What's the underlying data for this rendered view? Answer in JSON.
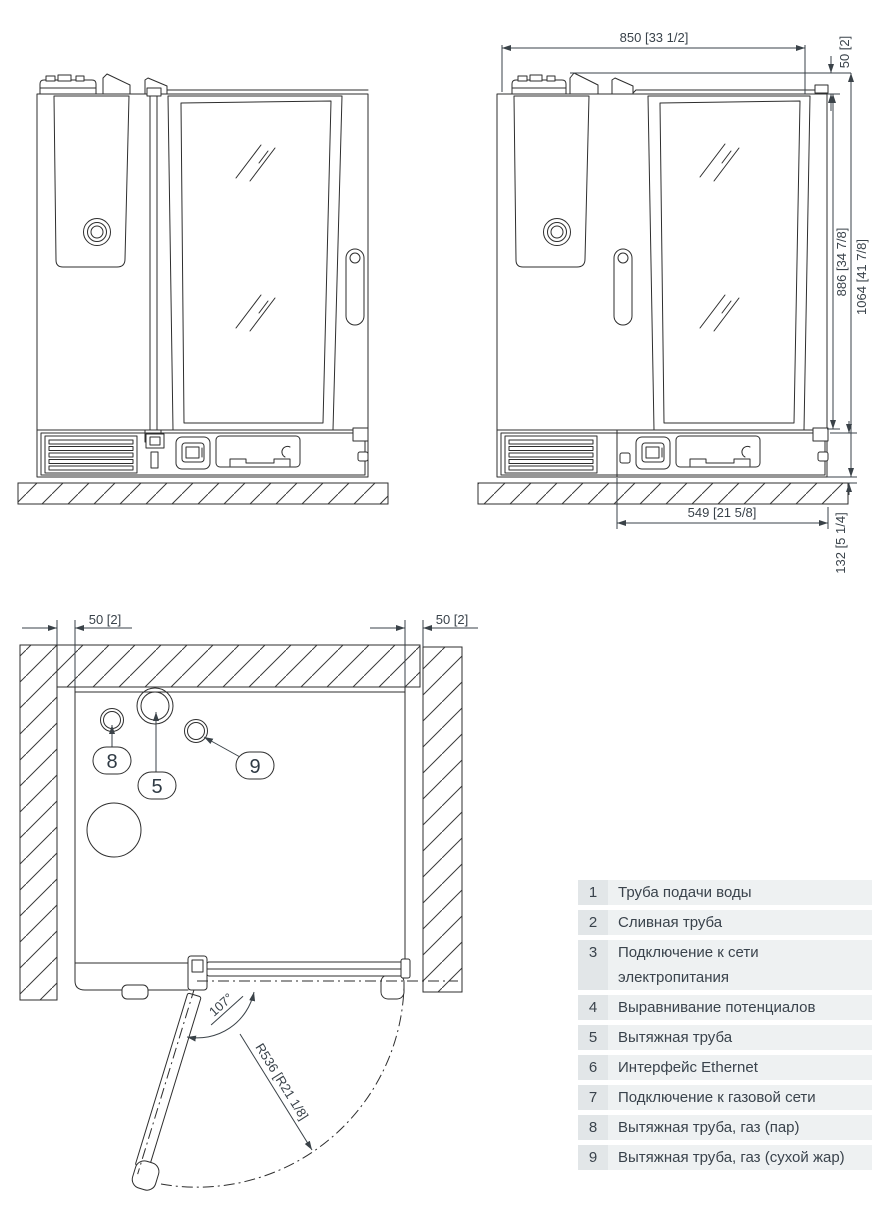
{
  "dimensions": {
    "width": "850 [33 1/2]",
    "top_section_height": "50 [2]",
    "body_height": "886 [34 7/8]",
    "total_height": "1064 [41 7/8]",
    "service_depth": "549 [21 5/8]",
    "plinth_height": "132 [5 1/4]",
    "wall_clearance_left": "50 [2]",
    "wall_clearance_right": "50 [2]",
    "door_opening_angle": "107°",
    "door_swing_radius": "R536 [R21 1/8]"
  },
  "top_view_callouts": {
    "exhaust_pipe": "5",
    "exhaust_gas_steam": "8",
    "exhaust_gas_dry": "9"
  },
  "legend": {
    "rows": [
      {
        "num": "1",
        "label": "Труба подачи воды"
      },
      {
        "num": "2",
        "label": "Сливная труба"
      },
      {
        "num": "3",
        "label": "Подключение к сети электропитания"
      },
      {
        "num": "4",
        "label": "Выравнивание потенциалов"
      },
      {
        "num": "5",
        "label": "Вытяжная труба"
      },
      {
        "num": "6",
        "label": "Интерфейс Ethernet"
      },
      {
        "num": "7",
        "label": "Подключение к газовой сети"
      },
      {
        "num": "8",
        "label": "Вытяжная труба, газ (пар)"
      },
      {
        "num": "9",
        "label": "Вытяжная труба, газ (сухой жар)"
      }
    ]
  }
}
